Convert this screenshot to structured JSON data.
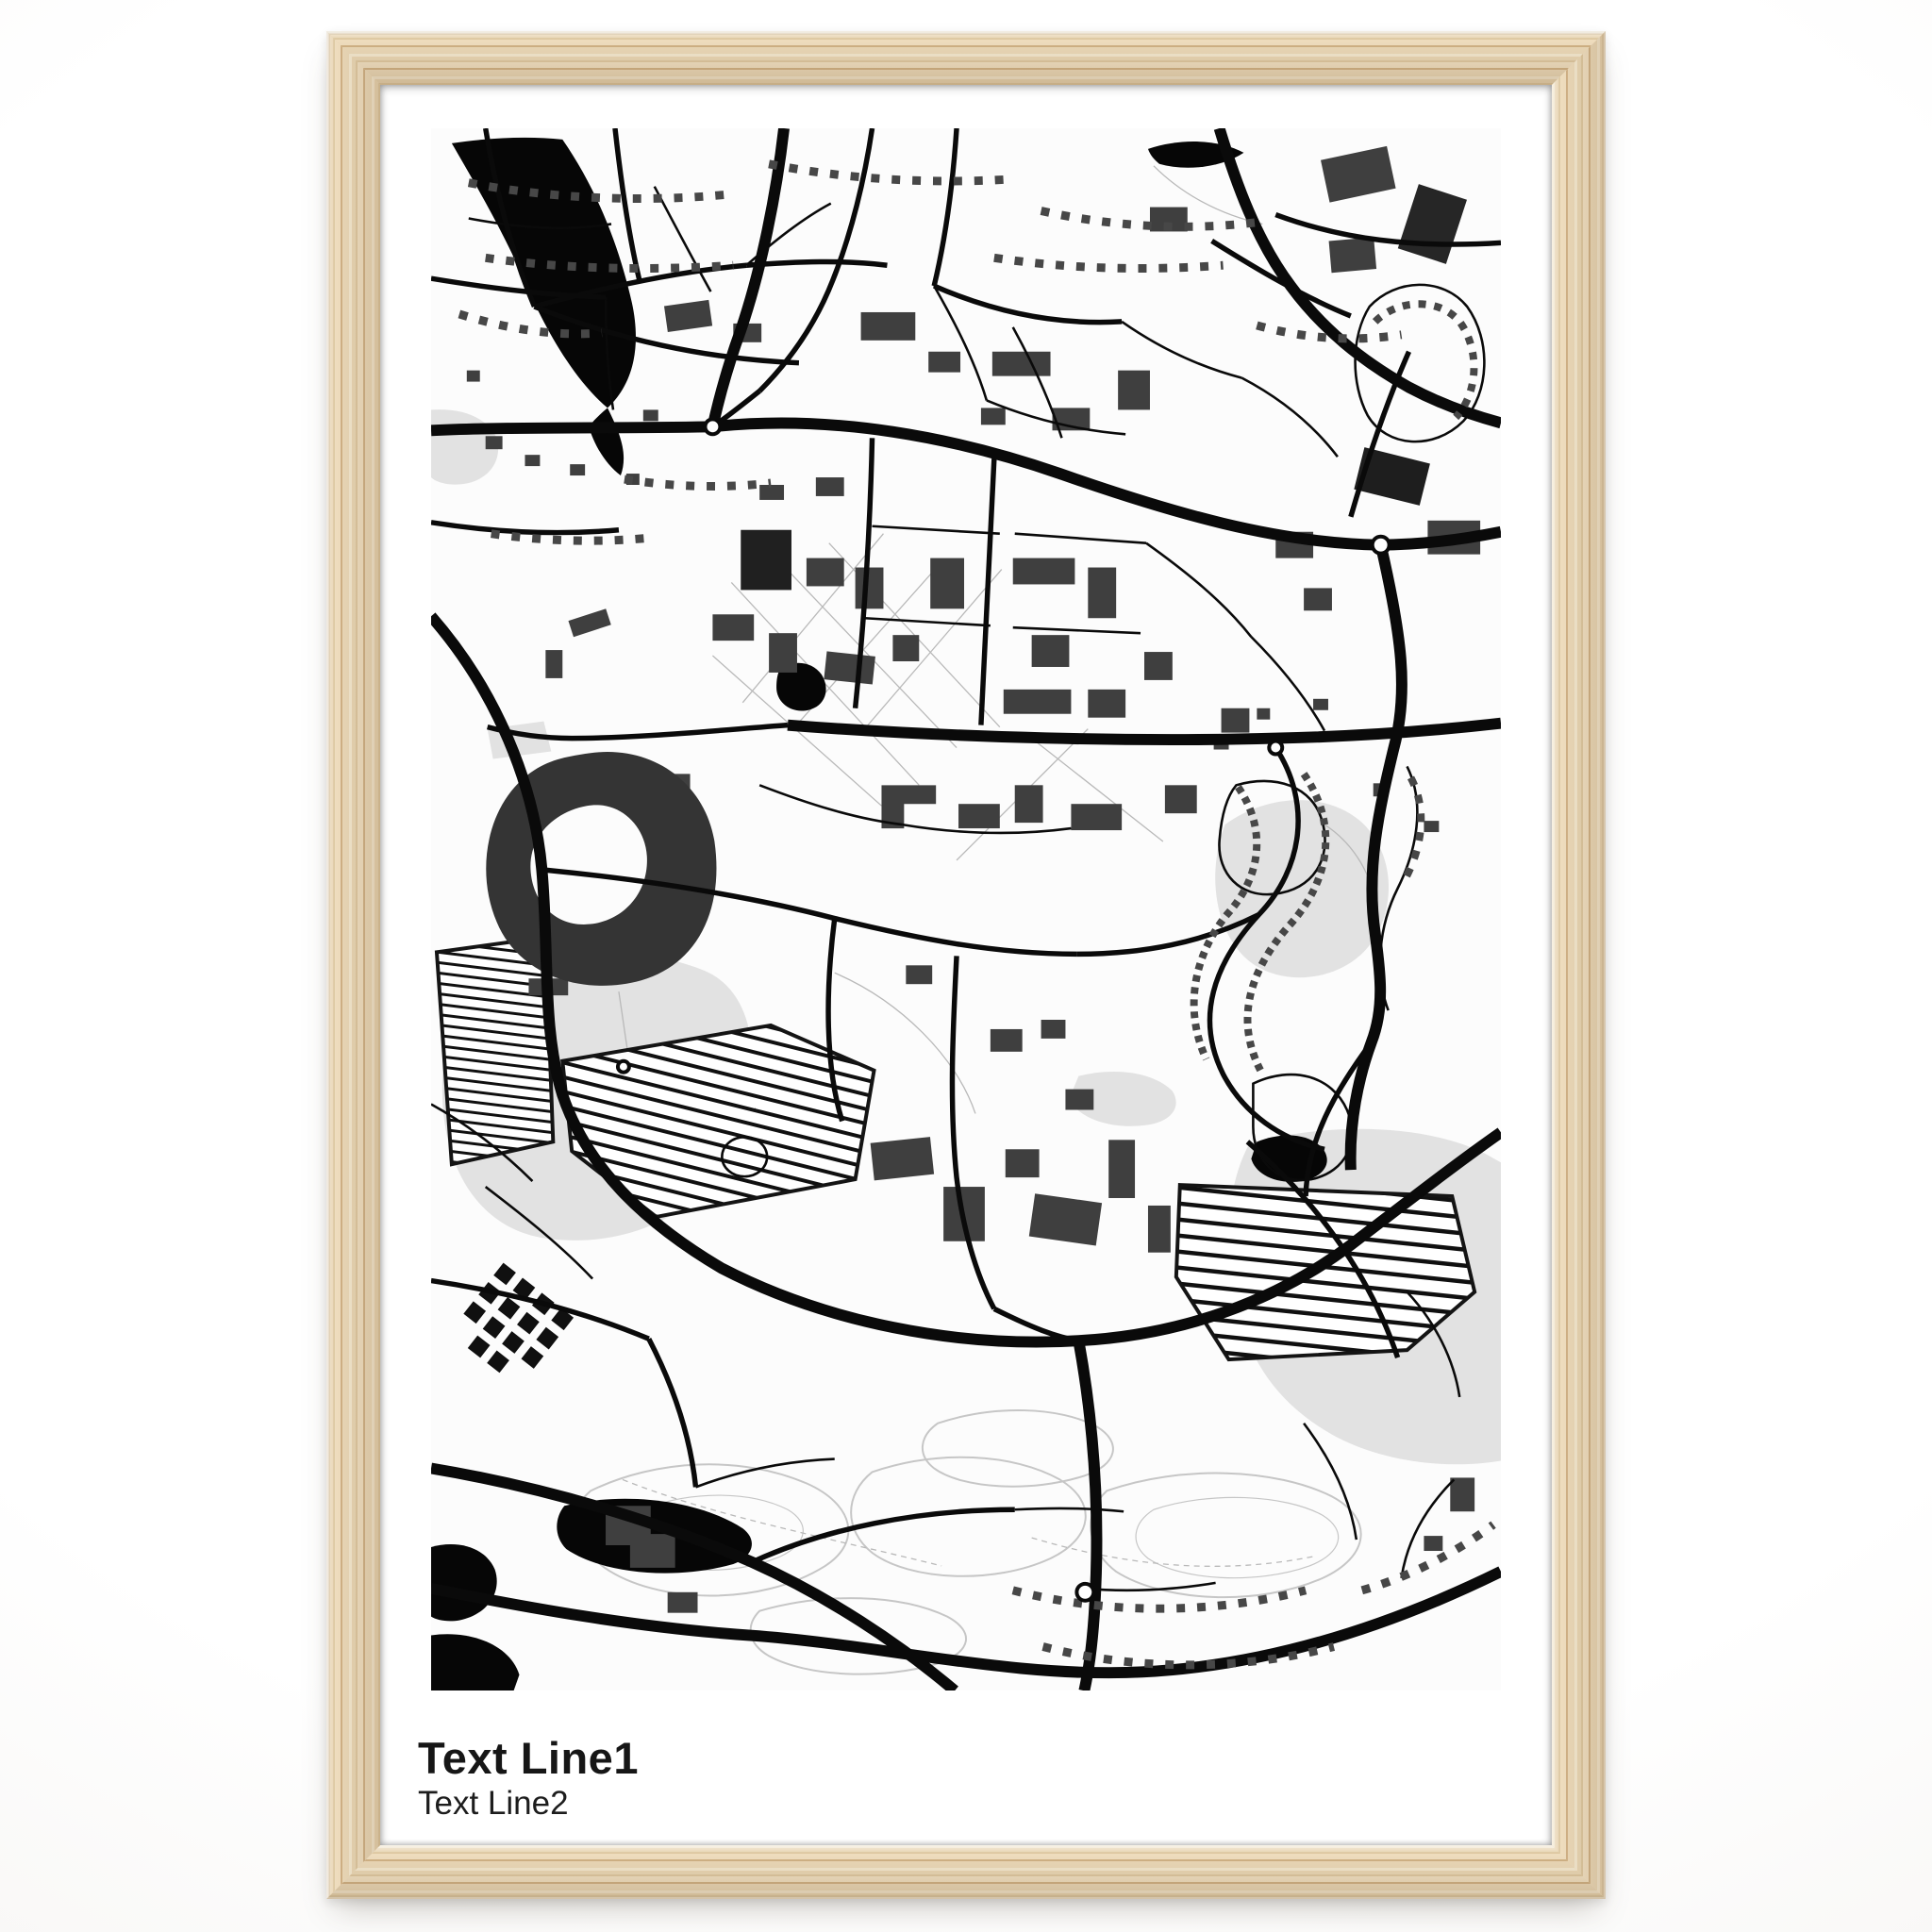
{
  "product": {
    "description": "Framed monochrome city street map poster mockup"
  },
  "frame": {
    "material": "natural light wood",
    "colors": {
      "light": "#f1e4ca",
      "mid": "#e7d3b0",
      "dark": "#cfb084"
    }
  },
  "poster": {
    "background": "#ffffff",
    "caption": {
      "line1": "Text Line1",
      "line2": "Text Line2",
      "color": "#161616"
    }
  },
  "map": {
    "style": "black and white street map",
    "colors": {
      "background": "#fcfcfc",
      "road": "#0a0a0a",
      "building": "#3f3f3f",
      "water": "#060606",
      "greenspace": "#e2e2e2",
      "contour": "#c6c6c6",
      "houses": "#474747",
      "trail": "#b9b9b9"
    }
  }
}
